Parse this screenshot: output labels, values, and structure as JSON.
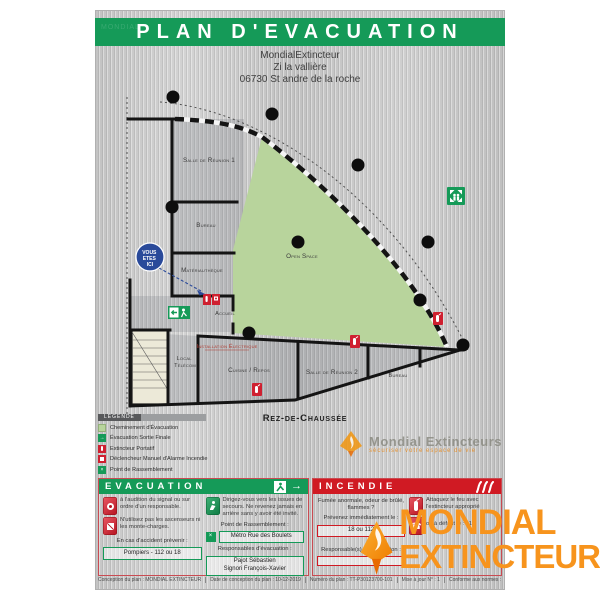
{
  "title": "PLAN D'EVACUATION",
  "address": {
    "line1": "MondialExtincteur",
    "line2": "Zi la vallière",
    "line3": "06730 St andre de la roche"
  },
  "map": {
    "floor_label": "Rez-de-Chaussée",
    "you_are_here": {
      "l1": "VOUS",
      "l2": "ETES",
      "l3": "ICI"
    },
    "rooms": {
      "salle1": "Salle de Réunion 1",
      "bureau1": "Bureau",
      "materiautheque": "Matériauthèque",
      "accueil": "Accueil",
      "open_space": "Open Space",
      "local_telecom_1": "Local",
      "local_telecom_2": "Télécom",
      "installation": "Installation  Électrique",
      "cuisine": "Cuisine / Repos",
      "salle2": "Salle de Réunion 2",
      "bureau2": "Bureau"
    }
  },
  "legend": {
    "header": "LÉGENDE",
    "items": [
      {
        "icon": "evacuation-path-swatch",
        "label": "Cheminement d'Évacuation"
      },
      {
        "icon": "final-exit-icon",
        "label": "Évacuation Sortie Finale"
      },
      {
        "icon": "extinguisher-icon",
        "label": "Extincteur Portatif"
      },
      {
        "icon": "manual-alarm-icon",
        "label": "Déclencheur Manuel d'Alarme Incendie"
      },
      {
        "icon": "assembly-point-icon",
        "label": "Point de Rassemblement"
      }
    ]
  },
  "watermark": {
    "name": "Mondial Extincteurs",
    "tagline": "sécuriser votre espace de vie"
  },
  "evacuation": {
    "title": "EVACUATION",
    "step_signal": "à l'audition du signal ou sur ordre d'un responsable.",
    "step_exits": "Dirigez-vous vers les issues de secours. Ne revenez jamais en arrière sans y avoir été invité.",
    "step_nolift": "N'utilisez pas les ascenseurs ni les monte-charges.",
    "assembly_label": "Point de Rassemblement :",
    "assembly_value": "Métro Rue des Boulets",
    "accident_label": "En cas d'accident prévenir :",
    "accident_value": "Pompiers - 112 ou 18",
    "resp_label": "Responsables d'évacuation :",
    "resp_1": "Pajot Sébastien",
    "resp_2": "Signori François-Xavier"
  },
  "incendie": {
    "title": "INCENDIE",
    "alert": "Fumée anormale, odeur de brûlé, flammes ?",
    "prevenez": "Prévenez immédiatement le :",
    "phone": "18 ou 112",
    "attack": "Attaquez le feu avec l'extincteur approprié",
    "fallback": "ou à défaut le : 112",
    "resp_label": "Responsable(s) d'intervention :"
  },
  "footer": {
    "conception": "Conception du plan : MONDIAL EXTINCTEUR",
    "date": "Date de conception du plan : 10-12-2019",
    "numero": "Numéro du plan : TT-P30123700-101",
    "maj": "Mise à jour N° : 1",
    "normes": "Conforme aux normes : NF X08-070 & ISO 3864-1 & ISO 3864-3"
  },
  "brand": {
    "line1": "MONDIAL",
    "line2": "EXTINCTEUR"
  },
  "colors": {
    "green": "#159a58",
    "red": "#d01a23",
    "orange": "#f7941d",
    "map_green": "#b8d49c",
    "blue": "#2a4a9a"
  }
}
